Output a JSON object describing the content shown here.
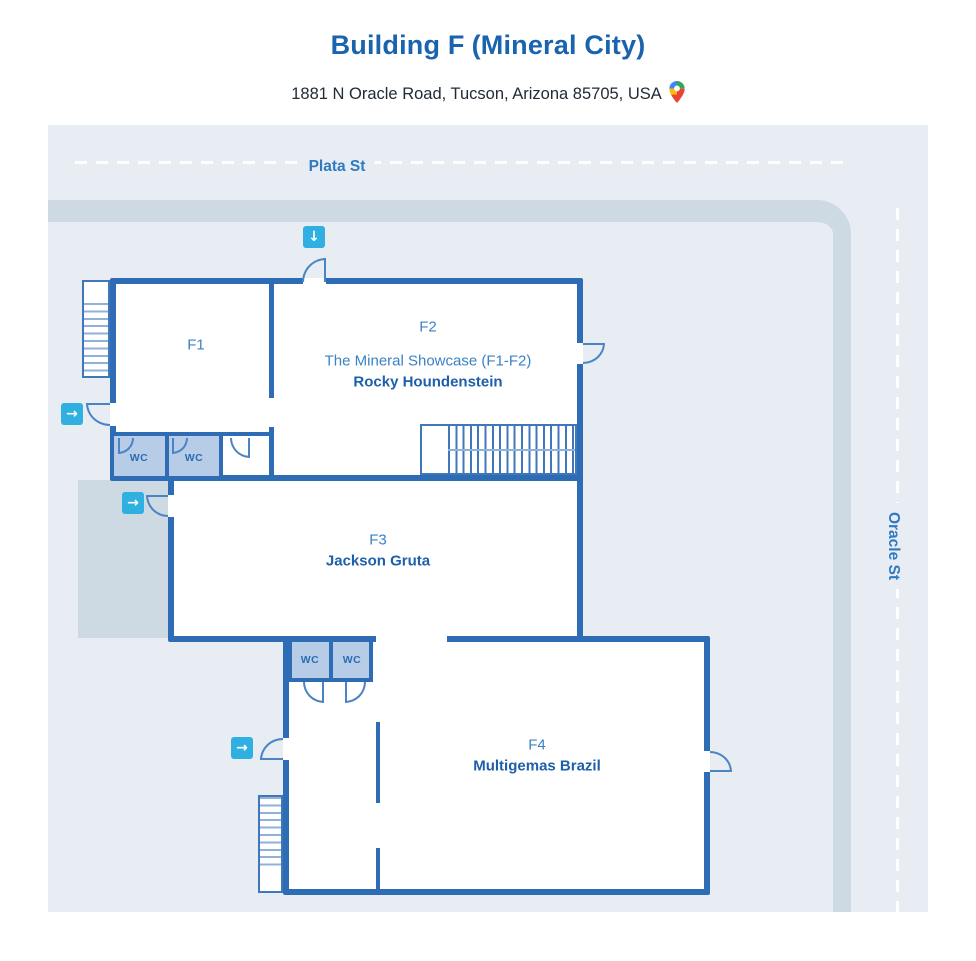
{
  "header": {
    "title_primary": "Building F",
    "title_secondary": "(Mineral City)",
    "address": "1881 N Oracle Road, Tucson, Arizona 85705, USA",
    "map_pin_icon": "google-maps-pin"
  },
  "streets": {
    "top": "Plata St",
    "right": "Oracle St"
  },
  "rooms": {
    "f1": {
      "label": "F1"
    },
    "f2": {
      "label": "F2",
      "subtitle": "The Mineral Showcase (F1-F2)",
      "tenant": "Rocky Houndenstein"
    },
    "f3": {
      "label": "F3",
      "tenant": "Jackson Gruta"
    },
    "f4": {
      "label": "F4",
      "tenant": "Multigemas Brazil"
    }
  },
  "wc": {
    "label": "WC"
  },
  "entrances": {
    "top": {
      "icon": "arrow-down",
      "glyph": "↓"
    },
    "f1_left": {
      "icon": "arrow-right",
      "glyph": "→"
    },
    "f3_left": {
      "icon": "arrow-right",
      "glyph": "→"
    },
    "f4_left": {
      "icon": "arrow-right",
      "glyph": "→"
    }
  },
  "colors": {
    "wall": "#2e6db6",
    "room_text": "#3b82c4",
    "tenant_text": "#1d5fa9",
    "entrance_marker": "#2fb0e0",
    "map_background": "#e8edf4",
    "sidewalk": "#cdd9e3",
    "wc_fill": "#b7cde7",
    "street_text": "#2f7ac0",
    "title_text": "#1a63ae",
    "door_arc": "#4a84c4"
  }
}
